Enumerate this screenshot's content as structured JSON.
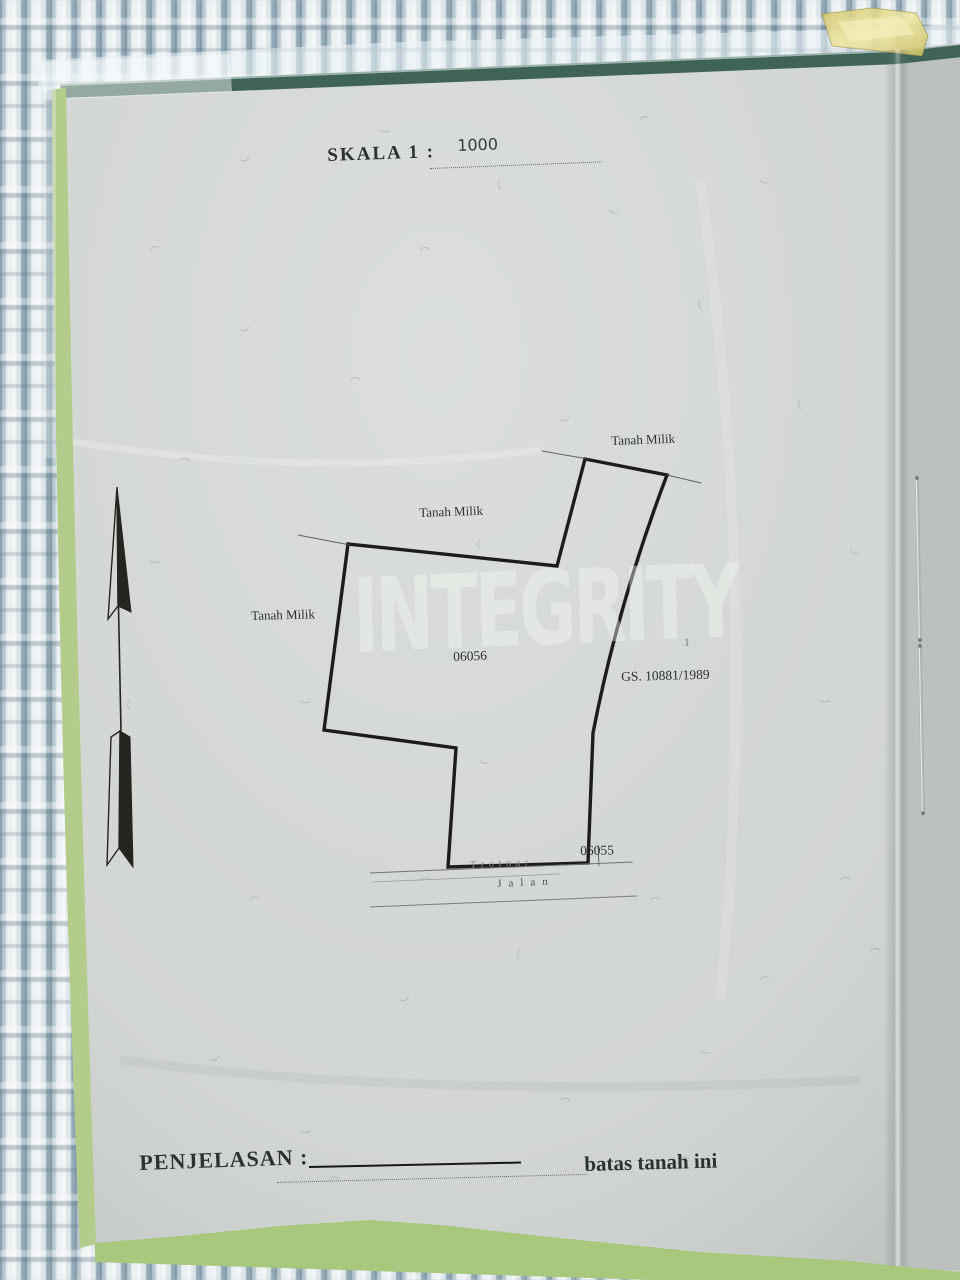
{
  "doc": {
    "scale_label": "SKALA 1 :",
    "scale_value": "1000",
    "labels": {
      "tanah_milik_top": "Tanah Milik",
      "tanah_milik_middle": "Tanah Milik",
      "tanah_milik_left": "Tanah Milik"
    },
    "parcel_number": "06056",
    "adjacent_parcel_number": "06055",
    "gs_number": "GS. 10881/1989",
    "sidewalk_label": "Trotoar",
    "road_label": "Jalan",
    "legend_label": "PENJELASAN :",
    "legend_description": "batas tanah ini",
    "watermark": "INTEGRITY",
    "pen_mark": "1",
    "colors": {
      "paper": "#d2d6d2",
      "cover_green_dark": "#3f6457",
      "cover_green_light": "#aecb82",
      "tape_yellow": "#ded27a",
      "boundary_ink": "#1a1d1a"
    }
  }
}
